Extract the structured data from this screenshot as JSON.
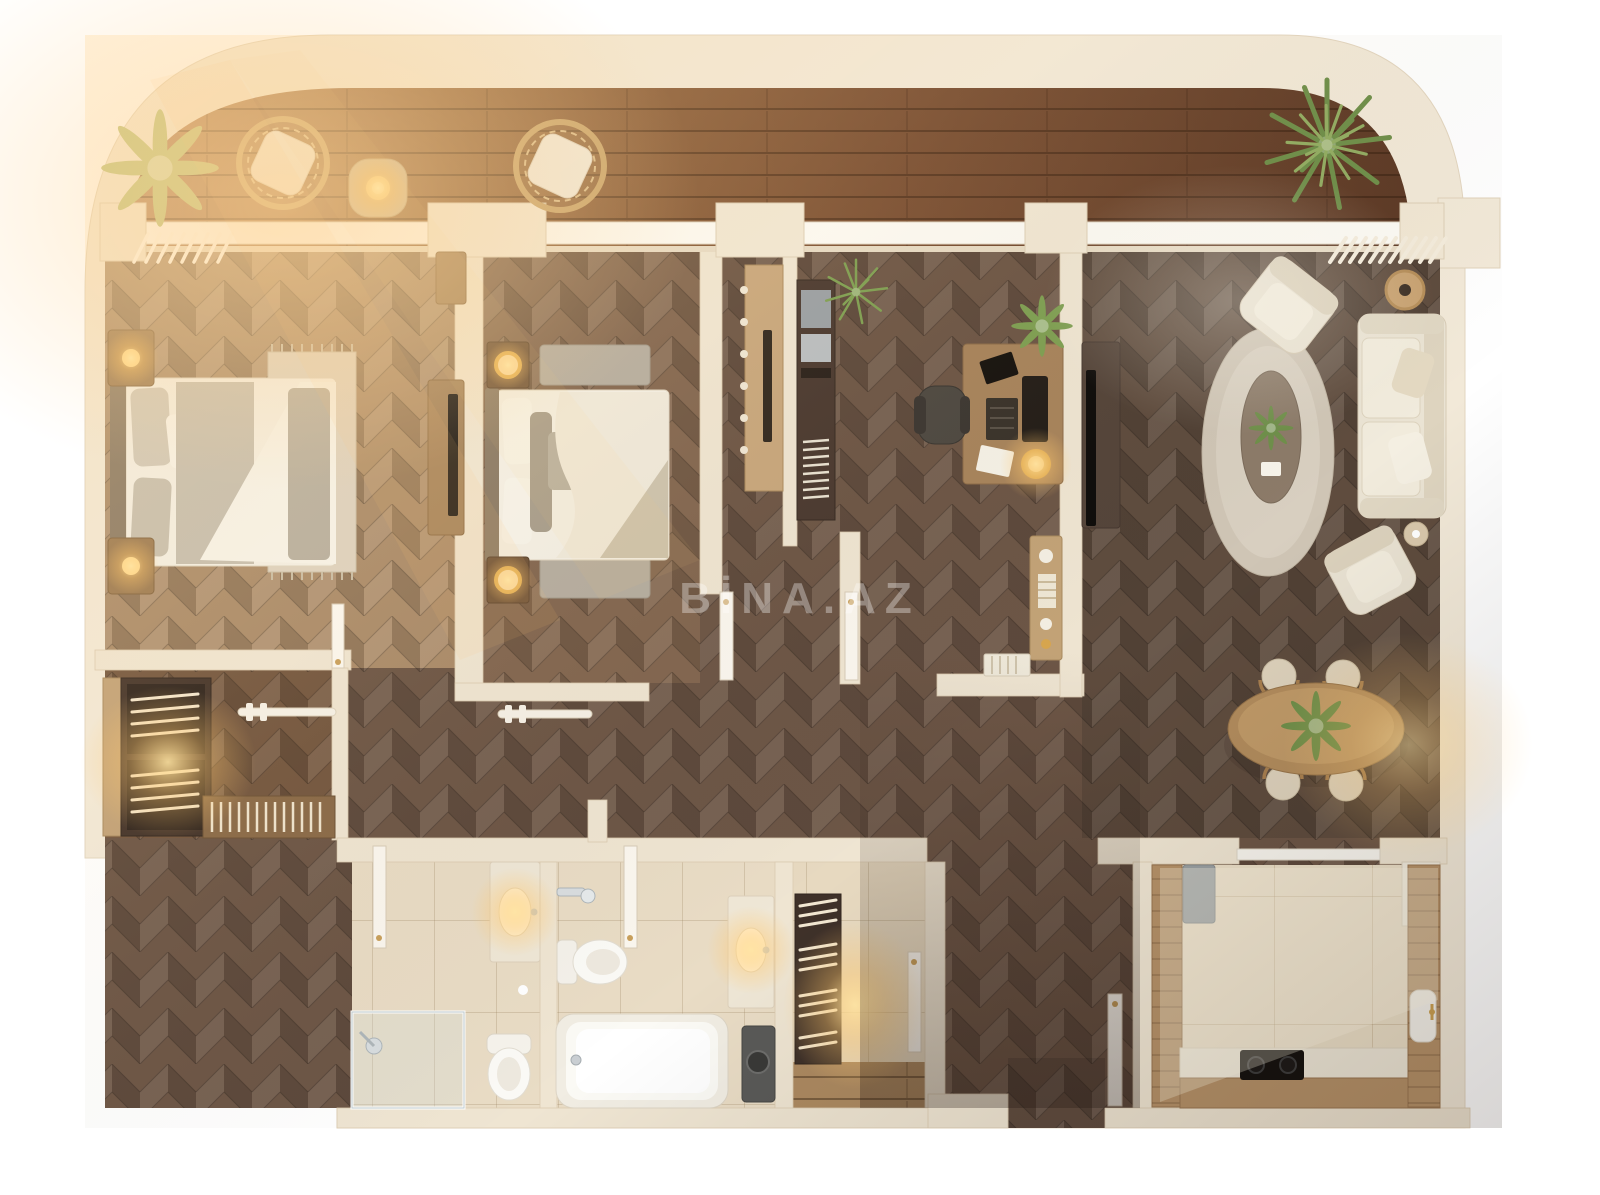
{
  "watermark": {
    "text": "BİNA.AZ"
  },
  "scene": {
    "type": "3d-floor-plan-top-view",
    "labels_visible": false,
    "description_elements": "apartment render with terrace, two bedrooms, wardrobe, office, living-dining room, two bathrooms, laundry, kitchen"
  },
  "palette": {
    "background": "#ffffff",
    "outer_wall": "#f2e9d8",
    "inner_wall": "#efe5d2",
    "window_frame": "#fcfaf4",
    "deck_wood_dark": "#5d3a26",
    "deck_wood_light": "#b3825a",
    "floor_dark": "#5f4c3e",
    "floor_light": "#aa8b6a",
    "bath_tile": "#e9dcc5",
    "kitchen_tile": "#ebdfc7",
    "counter_wood": "#b59168",
    "accent_gold": "#d8a64e",
    "glow_warm": "#ffdf9e",
    "linen": "#f3efe5",
    "sofa_ivory": "#eae3d3",
    "plant_green": "#6f8f4a"
  },
  "rooms": [
    {
      "name": "terrace",
      "furniture": [
        "potted-plant",
        "rattan-lounge-chair",
        "side-table-with-lamp",
        "rattan-lounge-chair",
        "palm-plant"
      ]
    },
    {
      "name": "bedroom-1",
      "furniture": [
        "double-bed",
        "rug",
        "nightstand-with-lamp",
        "nightstand-with-lamp",
        "tv-console",
        "dresser",
        "clothes-rail",
        "closet-door"
      ]
    },
    {
      "name": "bedroom-2",
      "furniture": [
        "double-bed",
        "nightstand-with-ring-lamp",
        "nightstand-with-ring-lamp",
        "bench",
        "bench",
        "door"
      ]
    },
    {
      "name": "walk-in-wardrobe",
      "furniture": [
        "wardrobe-shelving",
        "clothes-rail",
        "shoe-rack"
      ]
    },
    {
      "name": "hallway",
      "furniture": [
        "coat-rail",
        "open-door",
        "open-door"
      ]
    },
    {
      "name": "closet-niche-1",
      "furniture": [
        "wardrobe-cabinet-with-mirror"
      ]
    },
    {
      "name": "closet-niche-2",
      "furniture": [
        "open-shelving-unit",
        "potted-plant"
      ]
    },
    {
      "name": "home-office",
      "furniture": [
        "desk",
        "office-chair",
        "monitor",
        "laptop",
        "keyboard",
        "desk-lamp",
        "papers",
        "sideboard",
        "books",
        "potted-plant"
      ]
    },
    {
      "name": "living-room",
      "furniture": [
        "tv-console",
        "tv",
        "oval-rug",
        "coffee-table",
        "armchair",
        "sofa",
        "armchair",
        "rattan-side-table",
        "side-table",
        "pergola-blinds"
      ]
    },
    {
      "name": "dining-area",
      "furniture": [
        "oval-dining-table",
        "centerpiece-plant",
        "dining-chair",
        "dining-chair",
        "dining-chair",
        "dining-chair"
      ]
    },
    {
      "name": "bathroom-1",
      "furniture": [
        "vanity-sink",
        "toilet",
        "glass-shower",
        "door"
      ]
    },
    {
      "name": "bathroom-2",
      "furniture": [
        "bathtub",
        "toilet",
        "hand-shower",
        "vanity-sink",
        "washing-machine",
        "door"
      ]
    },
    {
      "name": "laundry-storage",
      "furniture": [
        "linen-shelving",
        "door"
      ]
    },
    {
      "name": "kitchen",
      "furniture": [
        "u-shaped-counter",
        "cooktop",
        "sink",
        "fridge",
        "corner-cabinet",
        "glass-partition",
        "door"
      ]
    },
    {
      "name": "entrance",
      "furniture": []
    }
  ]
}
